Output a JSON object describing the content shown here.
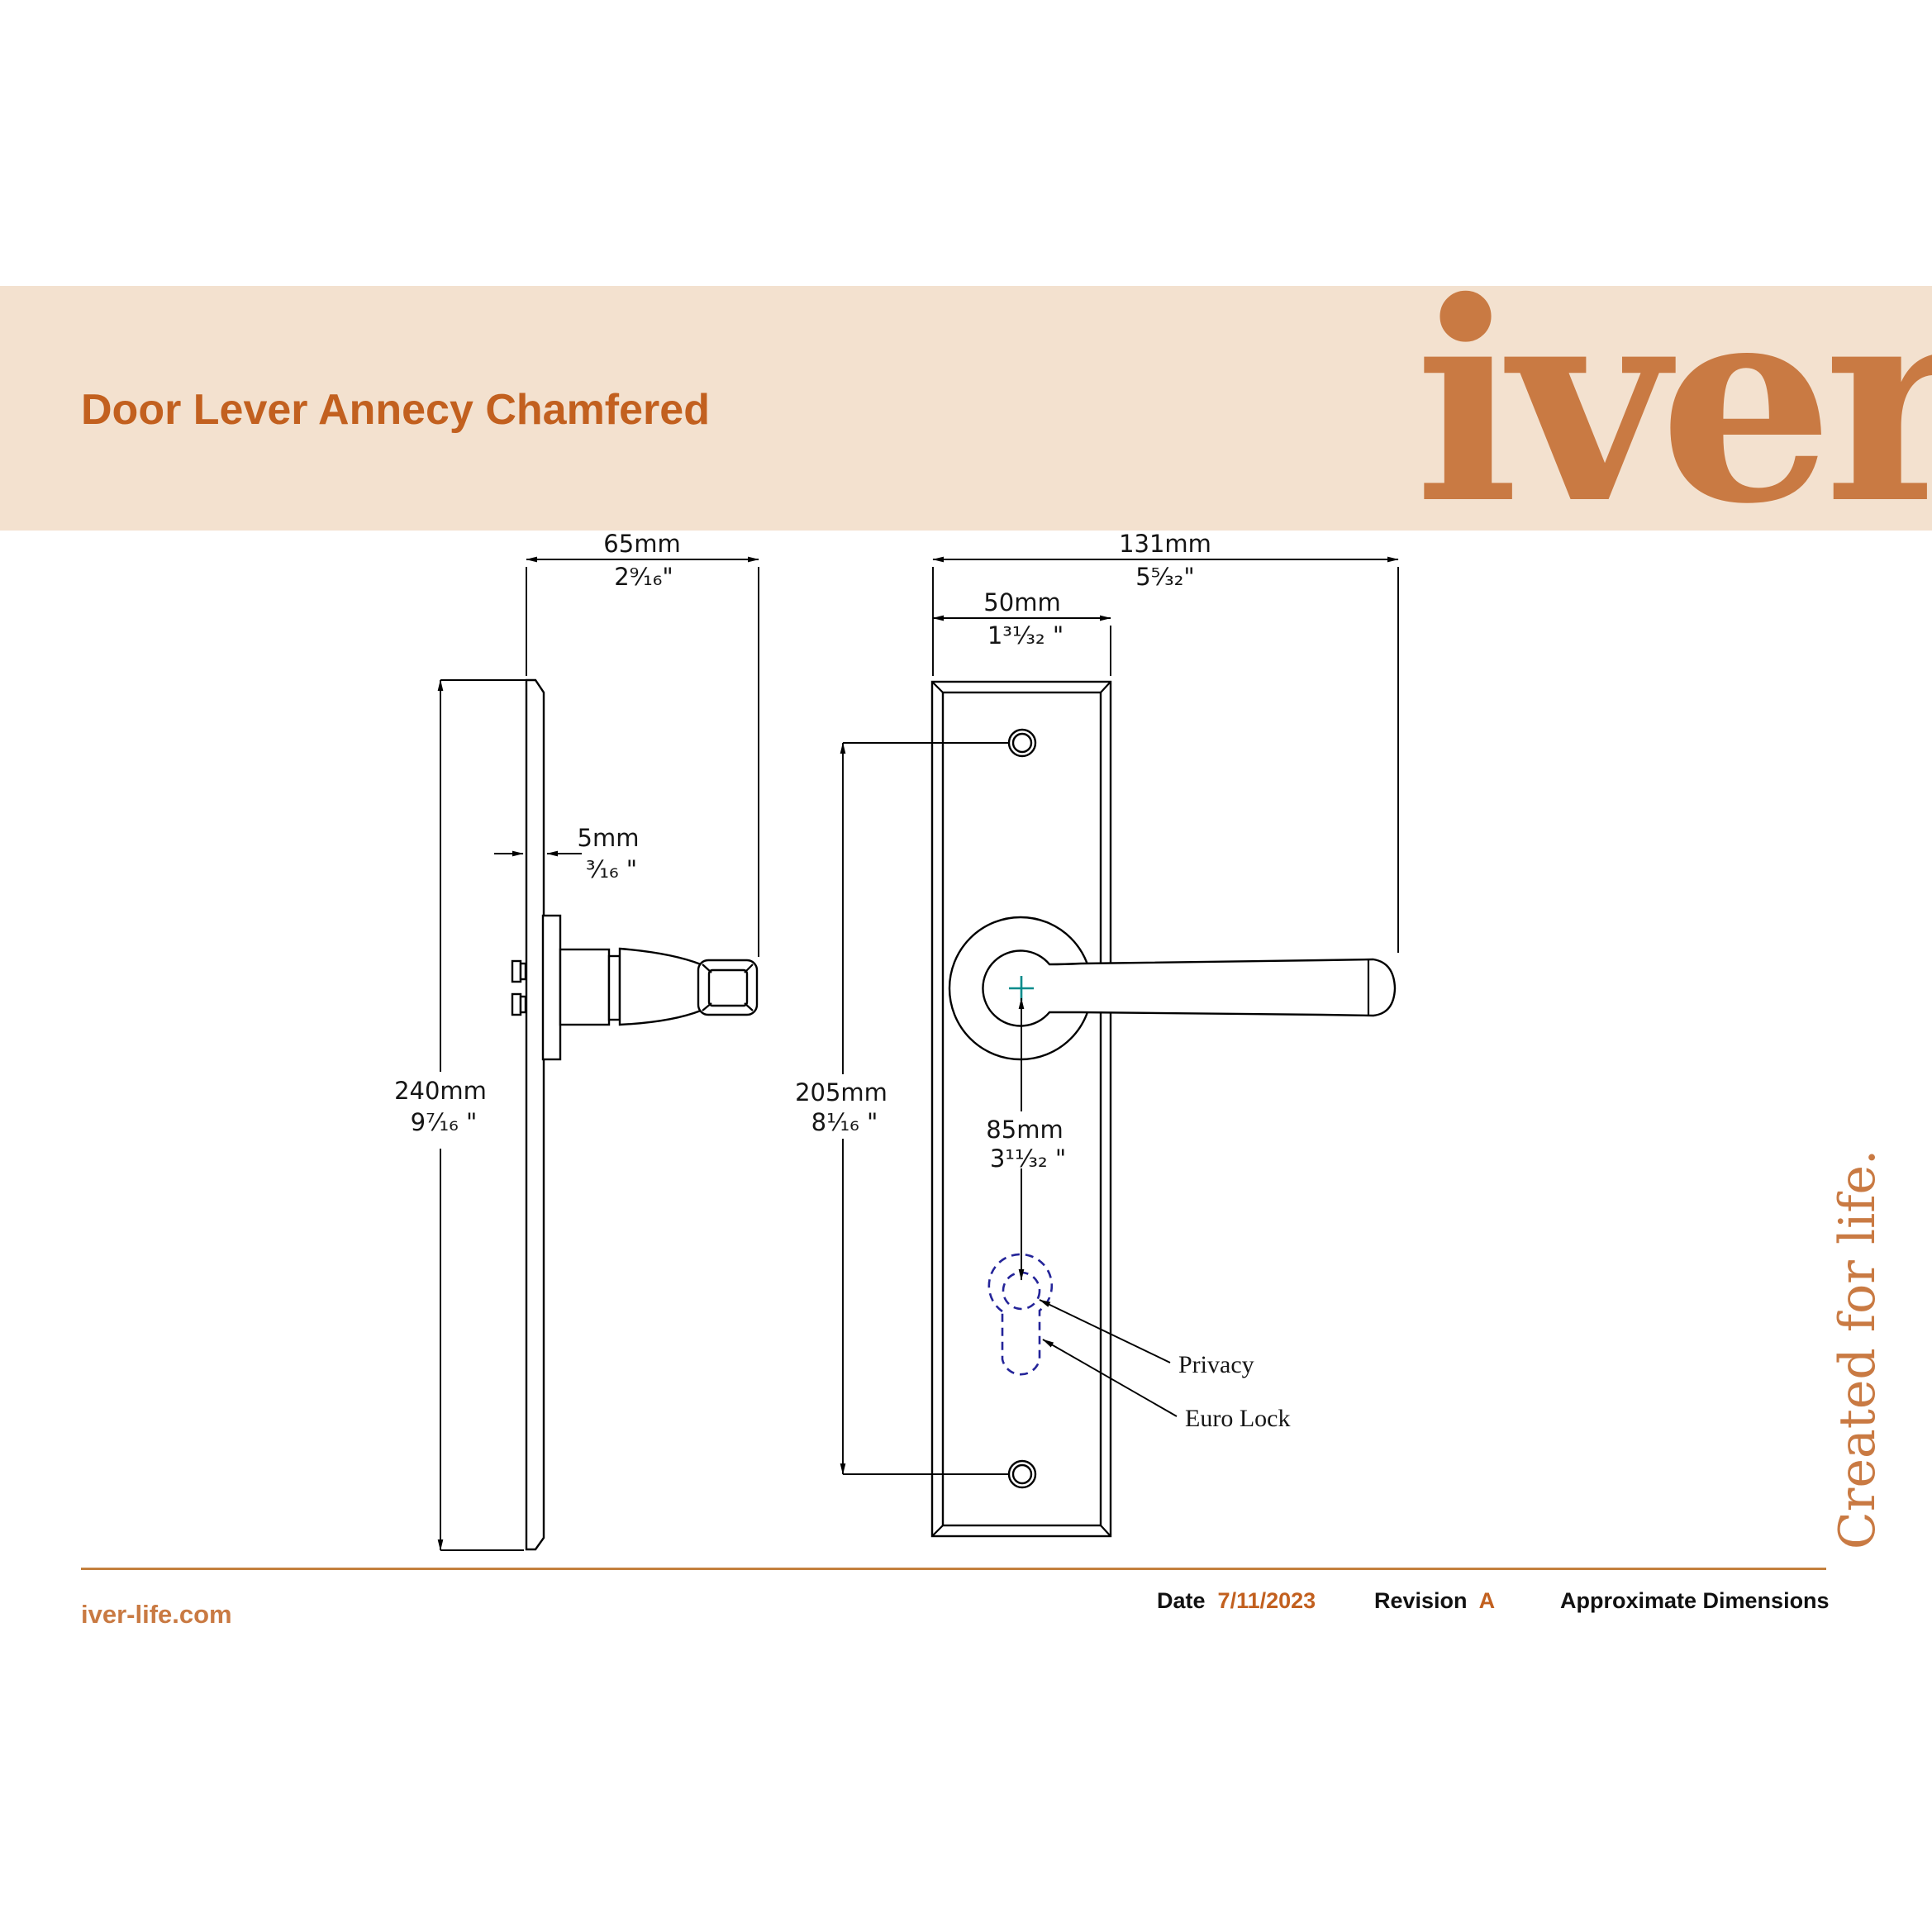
{
  "header": {
    "title": "Door Lever Annecy Chamfered",
    "logo": "iver"
  },
  "tagline": "Created for life.",
  "footer": {
    "website": "iver-life.com",
    "date_label": "Date",
    "date_value": "7/11/2023",
    "revision_label": "Revision",
    "revision_value": "A",
    "note": "Approximate Dimensions"
  },
  "dims": {
    "depth_mm": "65mm",
    "depth_in": "2⁹⁄₁₆\"",
    "projection_mm": "131mm",
    "projection_in": "5⁵⁄₃₂\"",
    "width_mm": "50mm",
    "width_in": "1³¹⁄₃₂ \"",
    "thickness_mm": "5mm",
    "thickness_in": "³⁄₁₆ \"",
    "height_mm": "240mm",
    "height_in": "9⁷⁄₁₆ \"",
    "centres_mm": "205mm",
    "centres_in": "8¹⁄₁₆ \"",
    "lock_mm": "85mm",
    "lock_in": "3¹¹⁄₃₂ \""
  },
  "annotations": {
    "privacy": "Privacy",
    "euro_lock": "Euro Lock"
  },
  "colors": {
    "band": "#F3E1CF",
    "accent": "#C2601F",
    "logo": "#C97A43",
    "divider": "#C4803E",
    "navy": "#242499",
    "teal": "#008B8B"
  }
}
